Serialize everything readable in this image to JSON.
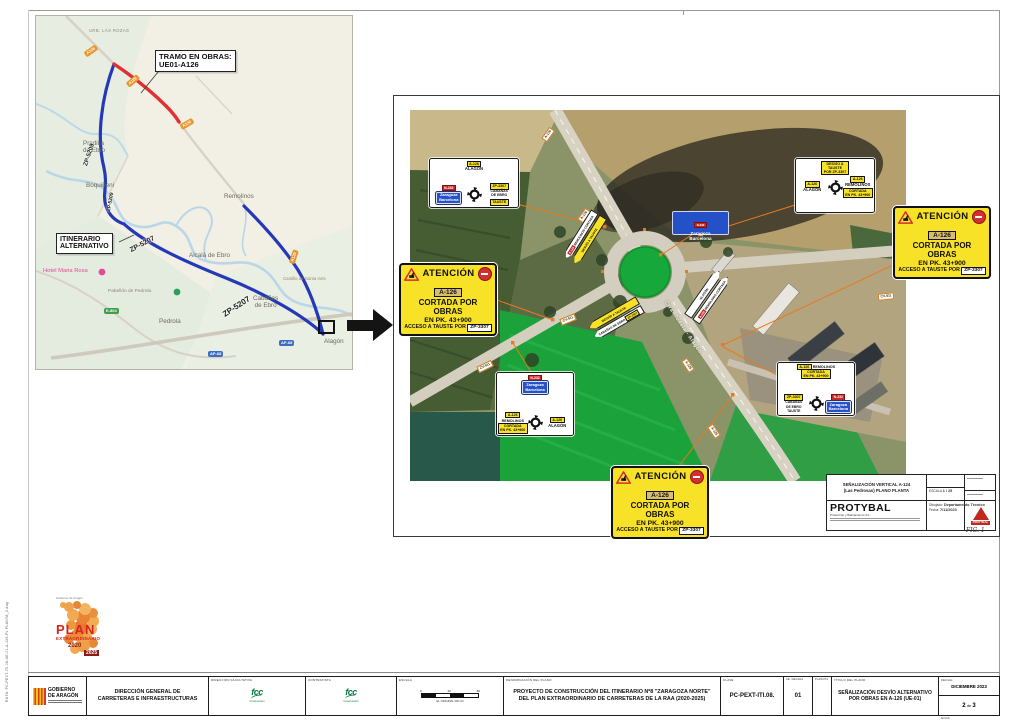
{
  "sheet": {
    "fig": "FIG. 1",
    "side_note": "RUTA: PC-PEXT-ITI.08-UE-01-A-126-PL PLANTA_2.dwg"
  },
  "map": {
    "callout_obras_l1": "TRAMO EN OBRAS:",
    "callout_obras_l2": "UE01-A126",
    "callout_alt_l1": "ITINERARIO",
    "callout_alt_l2": "ALTERNATIVO",
    "towns": {
      "urb": "URB. LAS ROZAS",
      "pradilla_l1": "Pradilla",
      "pradilla_l2": "de Ebro",
      "boquineni": "Boquiñeni",
      "remolinos": "Remolinos",
      "alcala": "Alcalá de Ebro",
      "cabanas_l1": "Cabañas",
      "cabanas_l2": "de Ebro",
      "pedrola": "Pedrola",
      "hotel": "Hotel Maria Rosa",
      "pabellon": "Pabellón de Pedrola",
      "castillo": "Castillo de Santa Inés",
      "alagon": "Alagón"
    },
    "roads": {
      "a126": "A126",
      "zp5209": "ZP-5209",
      "zp5207": "ZP-5207",
      "ap68": "AP-68",
      "e804": "E-804"
    }
  },
  "aerial": {
    "street": "Ctra. Tudela - Alagón",
    "badge_a126": "A-126",
    "badge_cv911": "CV-911",
    "attention": {
      "title": "ATENCIÓN",
      "road": "A-126",
      "l1": "CORTADA POR OBRAS",
      "l2": "EN PK. 43+900",
      "l3a": "ACCESO A TAUSTE POR",
      "l3b": "ZP-3307"
    },
    "panel_nw": {
      "top_badge": "A-126",
      "top_name": "ALAGÓN",
      "left_badge": "N-232",
      "left_l1": "Zaragoza",
      "left_l2": "Barcelona",
      "right_badge": "ZP-3307",
      "right_l1": "CABAÑAS",
      "right_l2": "DE EBRO",
      "right_l3": "TAUSTE"
    },
    "panel_ne": {
      "top_l1": "DESVÍO A",
      "top_l2": "TAUSTE",
      "top_l3": "POR ZP-3307",
      "left_badge": "A-126",
      "left_name": "ALAGÓN",
      "right_badge": "A-126",
      "right_name": "REMOLINOS",
      "right_note_l1": "CORTADA",
      "right_note_l2": "EN PK. 43+900"
    },
    "panel_sw": {
      "top_badge": "N-232",
      "top_l1": "Zaragoza",
      "top_l2": "Barcelona",
      "left_badge": "A-126",
      "left_name": "REMOLINOS",
      "left_note_l1": "CORTADA",
      "left_note_l2": "EN PK. 43+900",
      "right_badge": "A-126",
      "right_name": "ALAGÓN"
    },
    "panel_se": {
      "top_badge": "A-126",
      "top_name": "REMOLINOS",
      "top_note_l1": "CORTADA",
      "top_note_l2": "EN PK. 43+900",
      "left_badge": "ZP-3307",
      "left_l1": "CABAÑAS",
      "left_l2": "DE EBRO",
      "left_l3": "TAUSTE",
      "right_badge": "N-232",
      "right_l1": "Zaragoza",
      "right_l2": "Barcelona"
    },
    "blue_sign": {
      "badge": "N-232",
      "l1": "Zaragoza",
      "l2": "Barcelona"
    },
    "arrows": {
      "west_w": "REMOLINOS CORTADA",
      "west_y": "DESVÍO A TAUSTE",
      "south_y": "DESVÍO A TAUSTE",
      "south_w": "CABAÑAS DE EBRO",
      "south_chip": "ZP-3307",
      "east_w1": "ALAGÓN",
      "east_w2": "REMOLINOS CORTADA",
      "east_chip": "A-126"
    }
  },
  "miniblock": {
    "title_l1": "SEÑALIZACIÓN VERTICAL A-124",
    "title_l2": "(Las Pedrosas) PLANO PLANTA",
    "escala_label": "ESCALA",
    "escala_value": "1 / 25",
    "company": "PROTYBAL",
    "company_sub": "Protección y Balizamiento S.L.",
    "drawn_label": "Dibujado:",
    "drawn_value": "Departamento Técnico",
    "date_label": "Fecha:",
    "date_value": "7/11/2023",
    "logo_name": "PROTYBAL"
  },
  "titlebar": {
    "gob_l1": "GOBIERNO",
    "gob_l2": "DE ARAGÓN",
    "direccion_l1": "DIRECCIÓN GENERAL DE",
    "direccion_l2": "CARRETERAS E INFRAESTRUCTURAS",
    "cell3_label": "DIRECCIÓN FACULTATIVA",
    "cell4_label": "CONTRATISTA",
    "fcc": "fcc",
    "fcc_sub": "Construcción",
    "escala_label": "ESCALA",
    "escala_zero": "0",
    "escala_mid": "40",
    "escala_end": "80",
    "escala_note": "EL ORIGINAL DIN A3",
    "denom_label": "DENOMINACIÓN DEL PLANO",
    "project_l1": "PROYECTO DE CONSTRUCCIÓN DEL ITINERARIO Nº8 \"ZARAGOZA NORTE\"",
    "project_l2": "DEL PLAN EXTRAORDINARIO DE CARRETERAS DE LA RAA (2020-2025)",
    "clave_label": "CLAVE",
    "clave": "PC-PEXT-ITI.08.",
    "ud_label": "UE. DECADA",
    "ud": "01",
    "plano_label": "PLANCHA",
    "titulo_label": "TÍTULO DEL PLANO",
    "titulo_l1": "SEÑALIZACIÓN DESVÍO ALTERNATIVO",
    "titulo_l2": "POR OBRAS EN A-126 (UE-01)",
    "fecha_label": "FECHA:",
    "fecha": "DICIEMBRE 2023",
    "hoja_label": "HOJA",
    "hoja_num": "2",
    "hoja_de": "de",
    "hoja_total": "3"
  },
  "plan_logo": {
    "top": "Gobierno de Aragón",
    "l1": "PLAN",
    "l2": "EXTRAORDINARIO",
    "l3": "2020",
    "l4": "2025"
  }
}
